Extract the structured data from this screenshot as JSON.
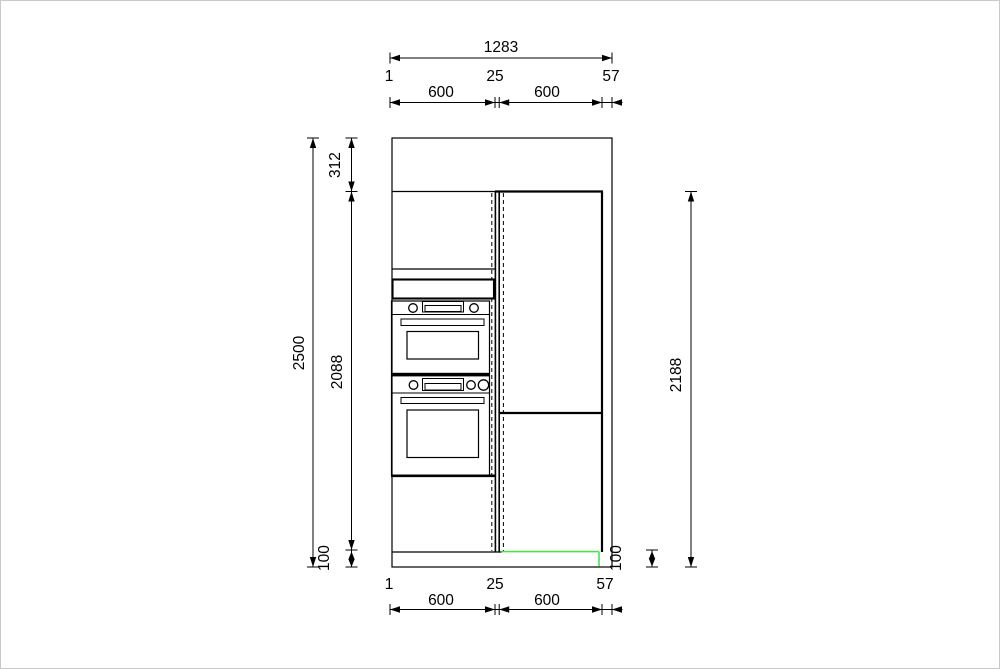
{
  "drawing": {
    "kind": "kitchen tall-unit elevation with dimensions",
    "units": "mm",
    "line_color": "#000000",
    "highlight_color": "#4be04b",
    "dimensions": {
      "top": {
        "total": "1283",
        "gap_left": "1",
        "cabinet_left": "600",
        "gap_middle": "25",
        "cabinet_right": "600",
        "gap_right": "57"
      },
      "bottom": {
        "gap_left": "1",
        "cabinet_left": "600",
        "gap_middle": "25",
        "cabinet_right": "600",
        "gap_right": "57"
      },
      "left": {
        "total": "2500",
        "ceiling_gap": "312",
        "cabinet_height": "2088",
        "plinth_height": "100"
      },
      "right": {
        "unit_height": "2188",
        "plinth_height": "100"
      }
    }
  }
}
